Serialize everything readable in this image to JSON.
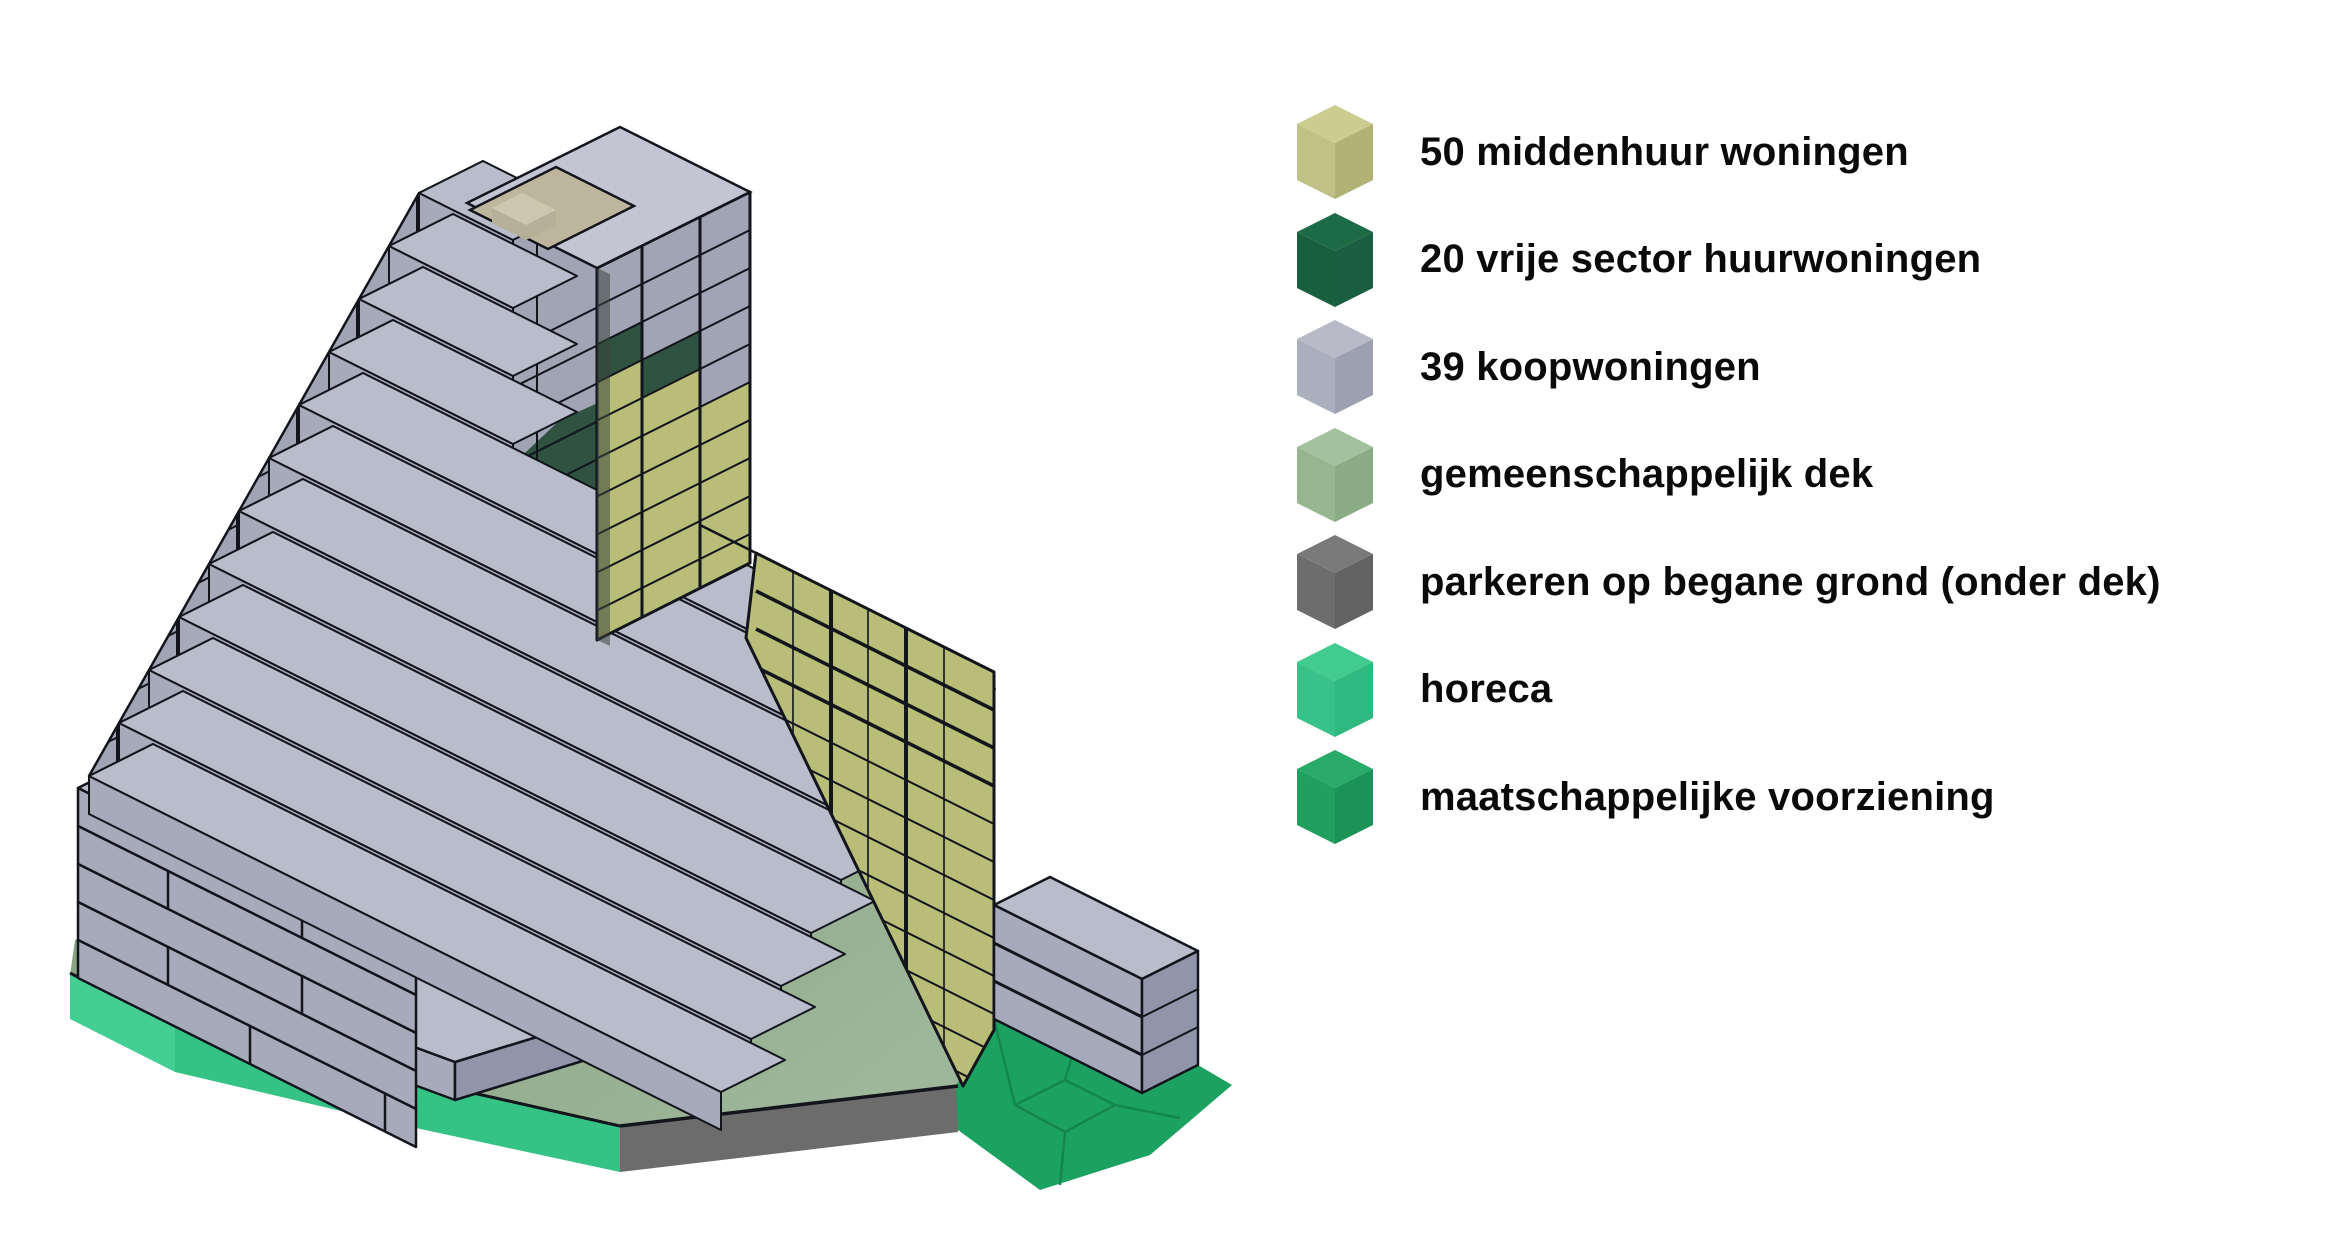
{
  "canvas": {
    "width": 2325,
    "height": 1247,
    "background": "#ffffff"
  },
  "legend": {
    "items": [
      {
        "label": "50 middenhuur woningen",
        "colors": {
          "top": "#cbcc90",
          "left": "#c0c186",
          "right": "#b1b275"
        }
      },
      {
        "label": "20 vrije sector huurwoningen",
        "colors": {
          "top": "#1d6b45",
          "left": "#16603c",
          "right": "#195e41"
        }
      },
      {
        "label": "39 koopwoningen",
        "colors": {
          "top": "#b8bac7",
          "left": "#abaebd",
          "right": "#9da0b1"
        }
      },
      {
        "label": "gemeenschappelijk dek",
        "colors": {
          "top": "#a3c19c",
          "left": "#97b690",
          "right": "#8aab83"
        }
      },
      {
        "label": "parkeren op begane grond (onder dek)",
        "colors": {
          "top": "#7a7a7a",
          "left": "#6d6d6d",
          "right": "#626262"
        }
      },
      {
        "label": "horeca",
        "colors": {
          "top": "#41cb8e",
          "left": "#38c287",
          "right": "#2fb97e"
        }
      },
      {
        "label": "maatschappelijke voorziening",
        "colors": {
          "top": "#28aa68",
          "left": "#20a05f",
          "right": "#1b9257"
        }
      }
    ]
  },
  "palette": {
    "olive_top": "#d0d392",
    "olive_face": "#b8bd77",
    "olive_deep": "#aaaf68",
    "gray_roof": "#c3c6d2",
    "gray_tread_top": "#b9bcca",
    "gray_face": "#a7aabb",
    "gray_side": "#9095a9",
    "gray_panel": "#a0a4b5",
    "dark_green": "#2f5340",
    "sage_light": "#9eb699",
    "sage_dark": "#7e9b78",
    "horeca_left": "#44cf92",
    "horeca_right": "#35c285",
    "parkeren": "#6c6c6c",
    "maatsch": "#1ca260",
    "maatsch_line": "#15854e",
    "tan_terrace": "#beb69c",
    "tan_box_top": "#cdc7af",
    "tan_box_side": "#b6b098",
    "passage_dark": "#8d8470",
    "passage_light": "#b2a98d",
    "line": "#12151c"
  }
}
